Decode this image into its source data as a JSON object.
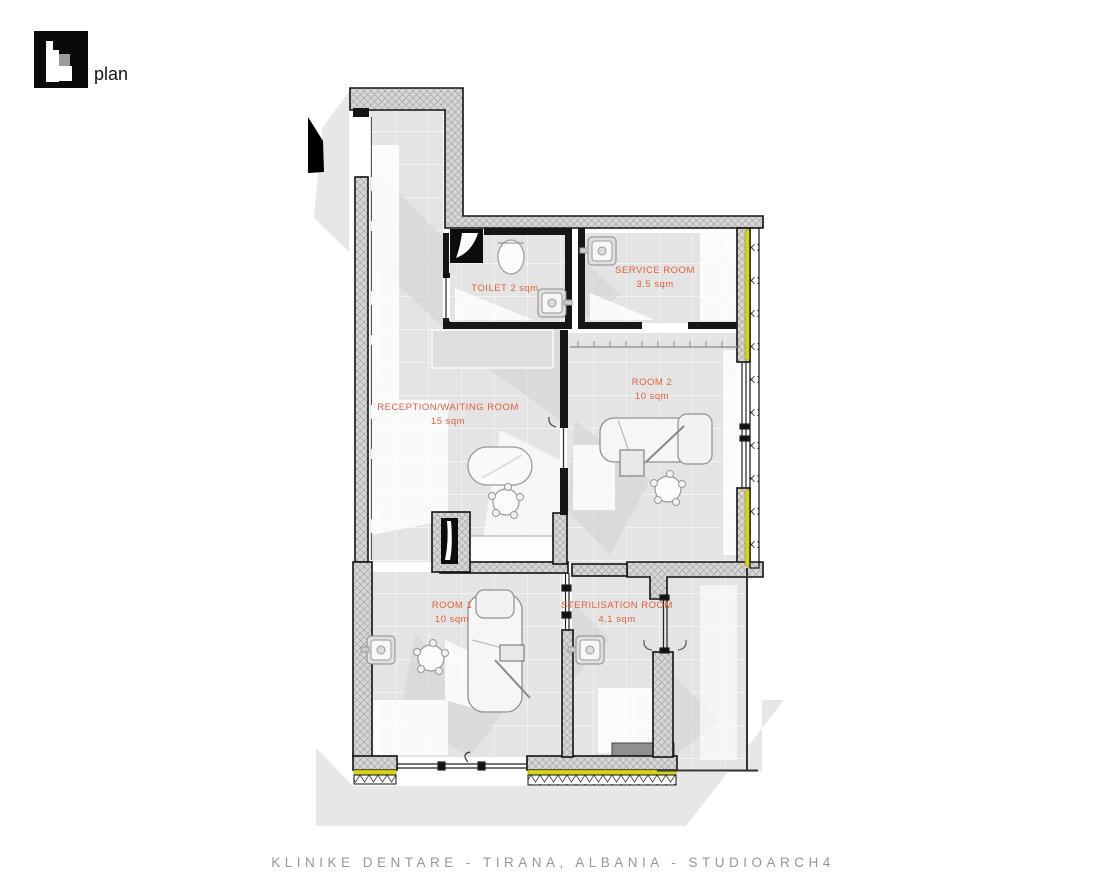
{
  "header": {
    "logo_text": "plan"
  },
  "plan": {
    "rooms": {
      "toilet": {
        "line1": "TOILET 2 sqm",
        "line2": ""
      },
      "service": {
        "line1": "SERVICE ROOM",
        "line2": "3.5 sqm"
      },
      "reception": {
        "line1": "RECEPTION/WAITING ROOM",
        "line2": "15 sqm"
      },
      "room2": {
        "line1": "ROOM 2",
        "line2": "10 sqm"
      },
      "room1": {
        "line1": "ROOM 1",
        "line2": "10 sqm"
      },
      "sterilisation": {
        "line1": "STERILISATION ROOM",
        "line2": "4.1 sqm"
      }
    }
  },
  "footer": {
    "title": "KLINIKE DENTARE -  TIRANA, ALBANIA  -  STUDIOARCH4"
  },
  "colors": {
    "label_orange": "#E2603A",
    "window_yellow": "#D6D21C",
    "wall_hatch_gray": "#A0A0A0",
    "floor_tile_gray": "#E4E4E4",
    "shadow_gray": "#E7E7E7",
    "title_gray": "#979797"
  },
  "icons": {
    "entry_arrow": "solid-black-wedge",
    "shaft": "black-square-with-white-vane",
    "window_marks": "x-and-v-hatch-symbols"
  }
}
